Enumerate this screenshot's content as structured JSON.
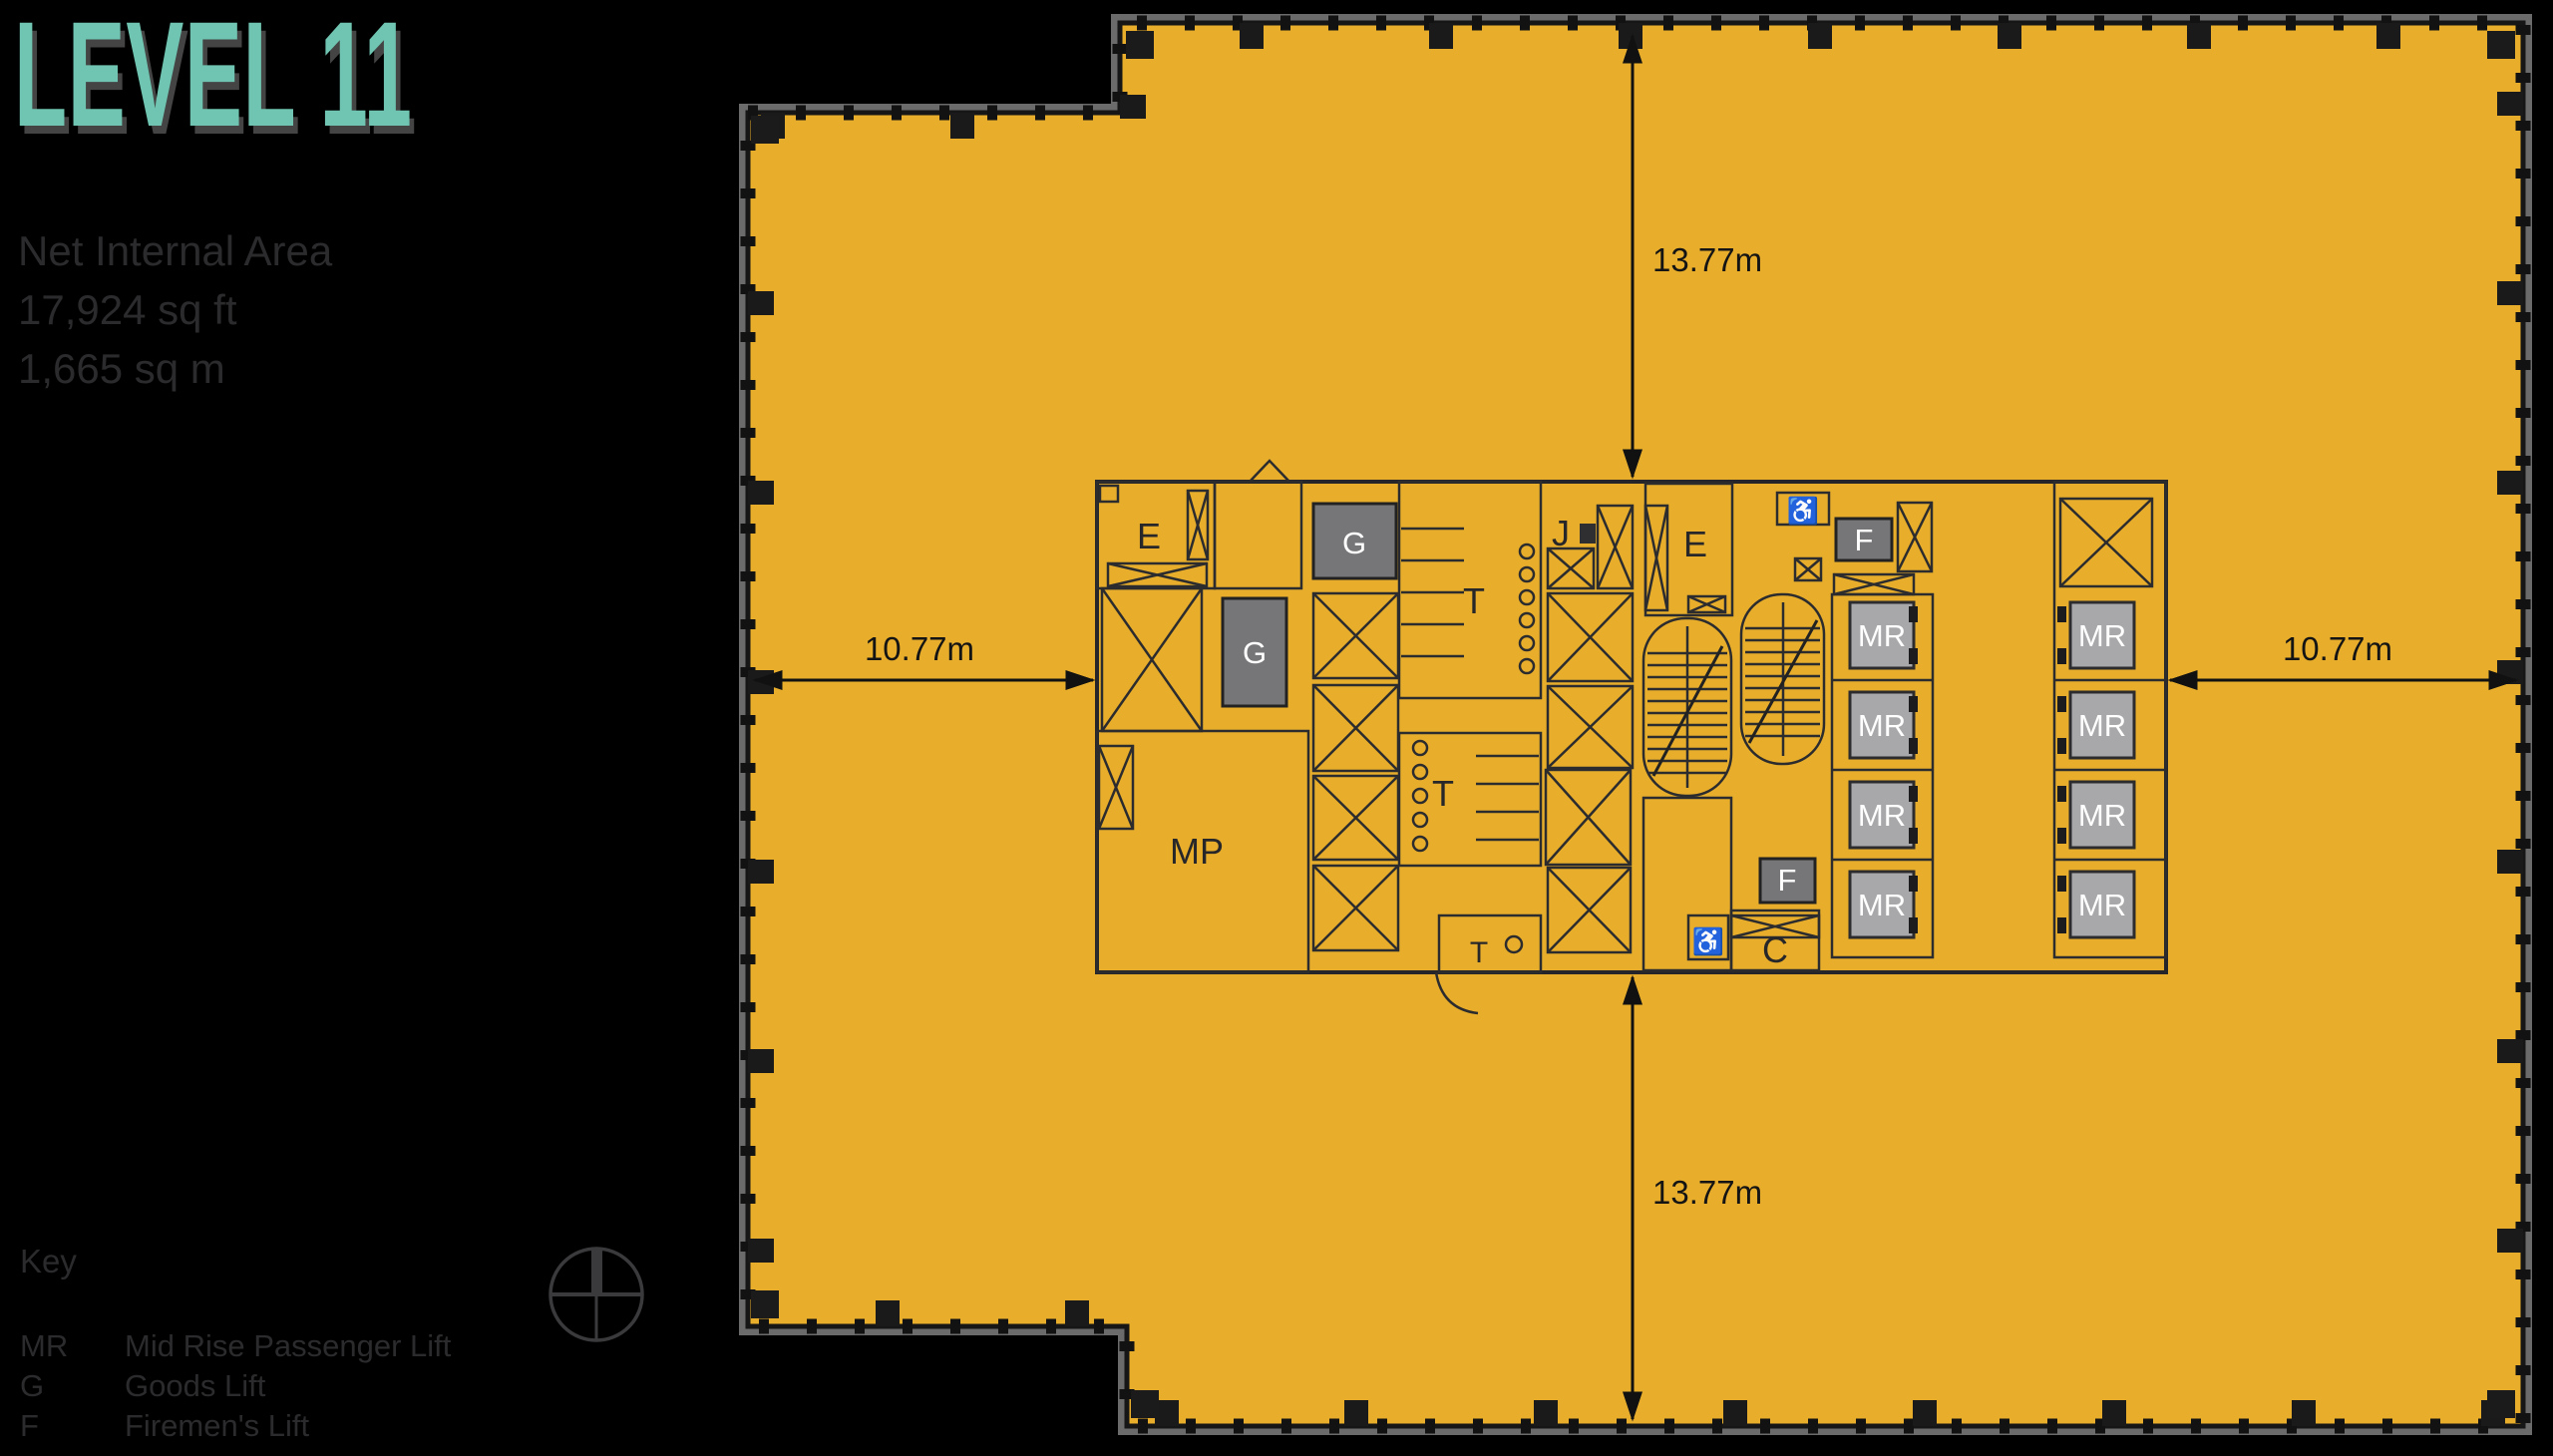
{
  "header": {
    "title": "LEVEL 11",
    "net_area_label": "Net Internal Area",
    "area_sqft": "17,924 sq ft",
    "area_sqm": "1,665 sq m"
  },
  "key": {
    "title": "Key",
    "entries": [
      {
        "abbr": "MR",
        "label": "Mid Rise Passenger Lift"
      },
      {
        "abbr": "G",
        "label": "Goods Lift"
      },
      {
        "abbr": "F",
        "label": "Firemen's Lift"
      }
    ]
  },
  "dimensions": {
    "top": "13.77m",
    "bottom": "13.77m",
    "left": "10.77m",
    "right": "10.77m"
  },
  "plan": {
    "room_labels": {
      "e": "E",
      "t": "T",
      "j": "J",
      "mp": "MP",
      "c": "C"
    },
    "lift_labels": {
      "mr": "MR",
      "g": "G",
      "f": "F"
    },
    "icons": {
      "accessible_wc": "♿"
    }
  },
  "colors": {
    "floor_yellow": "#E8AE2B",
    "title_teal": "#6FC5B1",
    "core_gray": "#C9C9CB",
    "lift_dark": "#767678",
    "lift_mid": "#A8A8AA",
    "line_dark": "#2c2c2e",
    "muted_text": "#2b2b2d"
  }
}
